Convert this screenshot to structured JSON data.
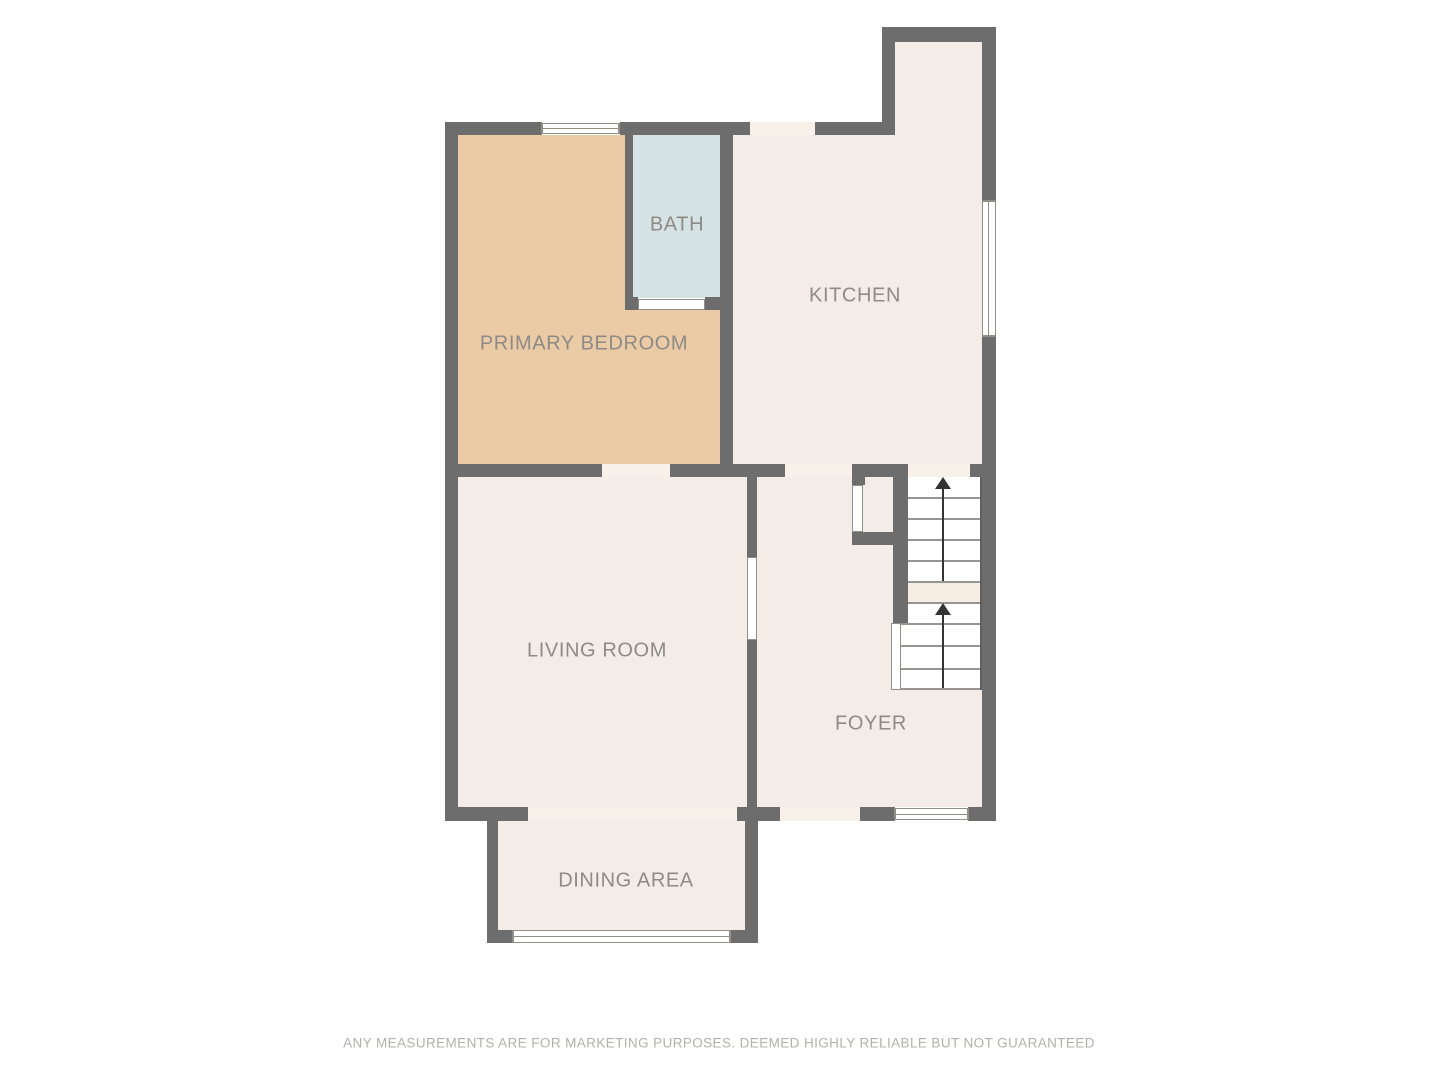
{
  "title": "First floor plan",
  "rooms": {
    "primary_bedroom": {
      "label": "PRIMARY BEDROOM"
    },
    "bath": {
      "label": "BATH"
    },
    "kitchen": {
      "label": "KITCHEN"
    },
    "living_room": {
      "label": "LIVING ROOM"
    },
    "foyer": {
      "label": "FOYER"
    },
    "dining_area": {
      "label": "DINING AREA"
    }
  },
  "stairs": {
    "flights": 2,
    "direction": "up",
    "up_arrow_icon": "▲"
  },
  "footer": {
    "disclaimer": "ANY MEASUREMENTS ARE FOR MARKETING PURPOSES. DEEMED HIGHLY RELIABLE BUT NOT GUARANTEED"
  },
  "colors": {
    "wall": "#6d6d6d",
    "floor": "#f4ece6",
    "floor_light": "#f7f1ea",
    "tan": "#ebcaa6",
    "bath_blue": "#d5e3e4",
    "landing": "#f5ece2",
    "white": "#ffffff",
    "frame": "#928e88",
    "tread": "#979593",
    "label": "#8e8b86",
    "disclaimer": "#b2b0ad",
    "arrow": "#333333",
    "page": "#ffffff"
  }
}
